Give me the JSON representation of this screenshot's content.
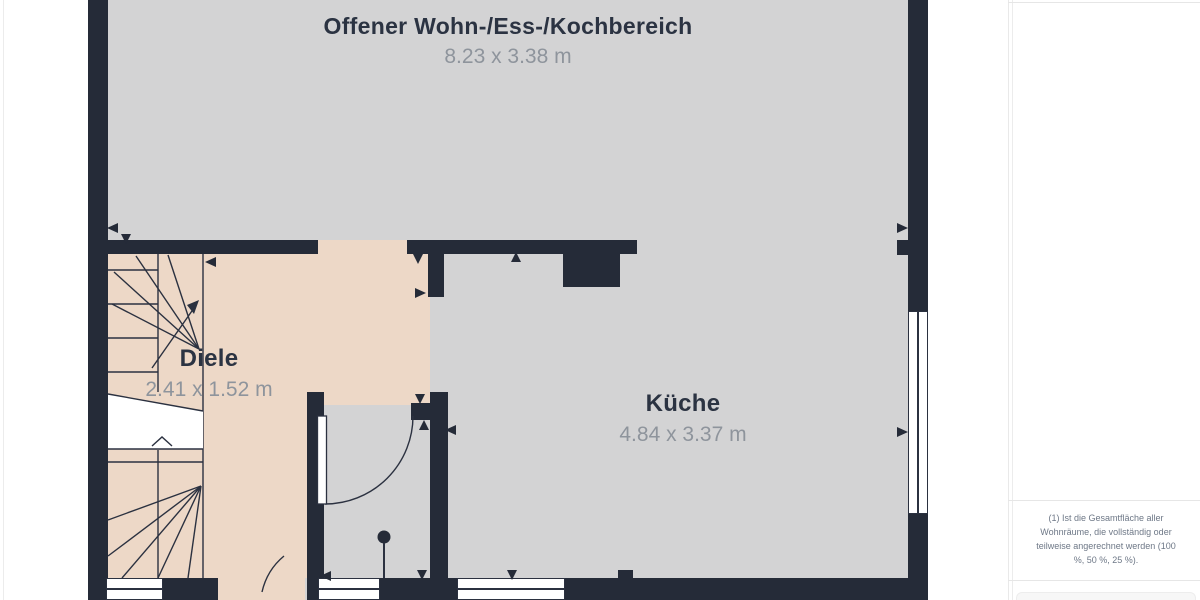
{
  "floor_plan": {
    "rooms": [
      {
        "name": "Offener Wohn-/Ess-/Kochbereich",
        "dims": "8.23 x 3.38 m"
      },
      {
        "name": "Diele",
        "dims": "2.41 x 1.52 m"
      },
      {
        "name": "Küche",
        "dims": "4.84 x 3.37 m"
      }
    ],
    "colors": {
      "wall": "#252b38",
      "floor": "#d3d3d4",
      "diele_floor": "#edd8c7",
      "window": "#ffffff",
      "room_label": "#2b3342",
      "dimension_text": "#8e949c"
    }
  },
  "sidebar": {
    "footnote": "(1) Ist die Gesamtfläche aller Wohnräume, die vollständig oder teilweise angerechnet werden (100 %, 50 %, 25 %)."
  }
}
